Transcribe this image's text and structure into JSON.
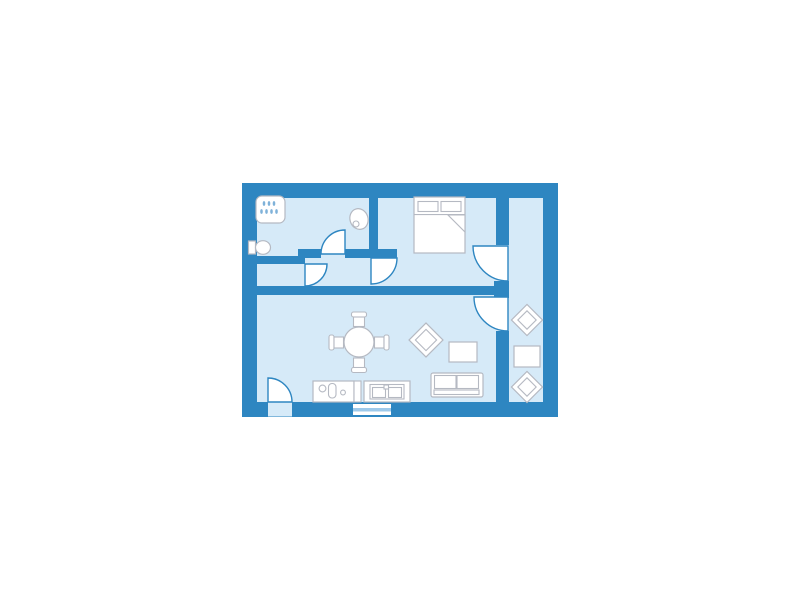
{
  "meta": {
    "canvas": {
      "width": 800,
      "height": 600,
      "background": "#ffffff"
    }
  },
  "palette": {
    "wall": "#2e86c1",
    "floor": "#d6eaf8",
    "door": "#2e86c1",
    "furn": "#b5b9c2",
    "white": "#ffffff",
    "glass": "#9ec9ea",
    "drop": "#7fb2d9"
  },
  "diagram": {
    "type": "floor-plan",
    "rooms": [
      "bathroom",
      "hall",
      "bedroom",
      "living-room-with-kitchen",
      "balcony"
    ],
    "shapes": [
      {
        "name": "apartment-floor-and-outer-wall",
        "kind": "rect",
        "x": 249.5,
        "y": 190.5,
        "w": 301,
        "h": 219,
        "fill": "floor",
        "stroke": "wall",
        "sw": 15
      },
      {
        "name": "balcony-wall-upper",
        "kind": "rect",
        "x": 496,
        "y": 198,
        "w": 13,
        "h": 47,
        "fill": "wall"
      },
      {
        "name": "balcony-wall-stub",
        "kind": "rect",
        "x": 494,
        "y": 281,
        "w": 15,
        "h": 17,
        "fill": "wall"
      },
      {
        "name": "balcony-wall-lower",
        "kind": "rect",
        "x": 496,
        "y": 331,
        "w": 13,
        "h": 71,
        "fill": "wall"
      },
      {
        "name": "living-room-north-wall",
        "kind": "rect",
        "x": 257,
        "y": 286,
        "w": 240,
        "h": 9,
        "fill": "wall"
      },
      {
        "name": "bathroom-south-wall-left",
        "kind": "rect",
        "x": 257,
        "y": 256,
        "w": 48,
        "h": 8,
        "fill": "wall"
      },
      {
        "name": "bathroom-south-wall-step",
        "kind": "rect",
        "x": 298,
        "y": 249,
        "w": 23,
        "h": 9,
        "fill": "wall"
      },
      {
        "name": "hall-north-wall-right",
        "kind": "rect",
        "x": 345,
        "y": 249,
        "w": 52,
        "h": 9,
        "fill": "wall"
      },
      {
        "name": "bedroom-west-wall",
        "kind": "rect",
        "x": 369,
        "y": 198,
        "w": 9,
        "h": 60,
        "fill": "wall"
      },
      {
        "name": "entry-doorway-gap",
        "kind": "rect",
        "x": 268,
        "y": 402.5,
        "w": 24,
        "h": 14,
        "fill": "floor"
      },
      {
        "name": "kitchen-window-frame",
        "kind": "rect",
        "x": 353,
        "y": 404,
        "w": 38,
        "h": 11,
        "fill": "white"
      },
      {
        "name": "kitchen-window-glass",
        "kind": "rect",
        "x": 353,
        "y": 408,
        "w": 38,
        "h": 3.5,
        "fill": "glass"
      },
      {
        "name": "shower-head",
        "kind": "rect",
        "x": 256,
        "y": 196,
        "w": 29,
        "h": 27,
        "rx": 6,
        "fill": "white",
        "stroke": "furn",
        "sw": 1.2
      },
      {
        "name": "shower-drop",
        "kind": "ellipse",
        "cx": 264,
        "cy": 203.5,
        "rx": 1.3,
        "ry": 2.4,
        "fill": "drop"
      },
      {
        "name": "shower-drop",
        "kind": "ellipse",
        "cx": 269,
        "cy": 203.5,
        "rx": 1.3,
        "ry": 2.4,
        "fill": "drop"
      },
      {
        "name": "shower-drop",
        "kind": "ellipse",
        "cx": 274,
        "cy": 203.5,
        "rx": 1.3,
        "ry": 2.4,
        "fill": "drop"
      },
      {
        "name": "shower-drop",
        "kind": "ellipse",
        "cx": 261.5,
        "cy": 211.5,
        "rx": 1.3,
        "ry": 2.4,
        "fill": "drop"
      },
      {
        "name": "shower-drop",
        "kind": "ellipse",
        "cx": 266.5,
        "cy": 211.5,
        "rx": 1.3,
        "ry": 2.4,
        "fill": "drop"
      },
      {
        "name": "shower-drop",
        "kind": "ellipse",
        "cx": 271.5,
        "cy": 211.5,
        "rx": 1.3,
        "ry": 2.4,
        "fill": "drop"
      },
      {
        "name": "shower-drop",
        "kind": "ellipse",
        "cx": 276.5,
        "cy": 211.5,
        "rx": 1.3,
        "ry": 2.4,
        "fill": "drop"
      },
      {
        "name": "toilet-tank",
        "kind": "rect",
        "x": 248.5,
        "y": 241,
        "w": 7,
        "h": 13,
        "fill": "white",
        "stroke": "furn",
        "sw": 1.2
      },
      {
        "name": "toilet-bowl",
        "kind": "ellipse",
        "cx": 263,
        "cy": 247.5,
        "rx": 7.5,
        "ry": 6.8,
        "fill": "white",
        "stroke": "furn",
        "sw": 1.2
      },
      {
        "name": "bathroom-sink-basin",
        "kind": "ellipse",
        "cx": 359,
        "cy": 219,
        "rx": 9,
        "ry": 10.5,
        "transform": "rotate(-18 359 219)",
        "fill": "white",
        "stroke": "furn",
        "sw": 1.2
      },
      {
        "name": "bathroom-sink-drain",
        "kind": "circle",
        "cx": 356,
        "cy": 224,
        "r": 3,
        "fill": "white",
        "stroke": "furn",
        "sw": 1.1
      },
      {
        "name": "bed",
        "kind": "rect",
        "x": 414,
        "y": 197,
        "w": 51,
        "h": 56,
        "fill": "white",
        "stroke": "furn",
        "sw": 1.2
      },
      {
        "name": "bed-pillow-left",
        "kind": "rect",
        "x": 418,
        "y": 201.5,
        "w": 20,
        "h": 10,
        "fill": "white",
        "stroke": "furn",
        "sw": 1.1
      },
      {
        "name": "bed-pillow-right",
        "kind": "rect",
        "x": 441,
        "y": 201.5,
        "w": 20,
        "h": 10,
        "fill": "white",
        "stroke": "furn",
        "sw": 1.1
      },
      {
        "name": "bed-sheet-line",
        "kind": "rect",
        "x": 414,
        "y": 214,
        "w": 51,
        "h": 1.1,
        "fill": "furn"
      },
      {
        "name": "bed-blanket-fold",
        "kind": "polygon",
        "points": "448,215 465,215 465,232",
        "fill": "white",
        "stroke": "furn",
        "sw": 1.1
      },
      {
        "name": "balcony-chair-top",
        "kind": "rect",
        "x": 516,
        "y": 309,
        "w": 22,
        "h": 22,
        "transform": "rotate(45 527 320)",
        "fill": "white",
        "stroke": "furn",
        "sw": 1.2
      },
      {
        "name": "balcony-chair-top-cushion",
        "kind": "rect",
        "x": 520.5,
        "y": 313.5,
        "w": 13,
        "h": 13,
        "transform": "rotate(45 527 320)",
        "fill": "white",
        "stroke": "furn",
        "sw": 1.1
      },
      {
        "name": "balcony-table",
        "kind": "rect",
        "x": 514,
        "y": 346,
        "w": 26,
        "h": 21,
        "fill": "white",
        "stroke": "furn",
        "sw": 1.2
      },
      {
        "name": "balcony-chair-bottom",
        "kind": "rect",
        "x": 516,
        "y": 376,
        "w": 22,
        "h": 22,
        "transform": "rotate(45 527 387)",
        "fill": "white",
        "stroke": "furn",
        "sw": 1.2
      },
      {
        "name": "balcony-chair-bottom-cushion",
        "kind": "rect",
        "x": 520.5,
        "y": 380.5,
        "w": 13,
        "h": 13,
        "transform": "rotate(45 527 387)",
        "fill": "white",
        "stroke": "furn",
        "sw": 1.1
      },
      {
        "name": "dining-chair-north-back",
        "kind": "rect",
        "x": 351.5,
        "y": 312,
        "w": 15,
        "h": 5,
        "rx": 2,
        "fill": "white",
        "stroke": "furn",
        "sw": 1.1
      },
      {
        "name": "dining-chair-north-seat",
        "kind": "rect",
        "x": 353.5,
        "y": 317,
        "w": 11,
        "h": 9.5,
        "fill": "white",
        "stroke": "furn",
        "sw": 1.1
      },
      {
        "name": "dining-chair-south-seat",
        "kind": "rect",
        "x": 353.5,
        "y": 358,
        "w": 11,
        "h": 9.5,
        "fill": "white",
        "stroke": "furn",
        "sw": 1.1
      },
      {
        "name": "dining-chair-south-back",
        "kind": "rect",
        "x": 351.5,
        "y": 367.5,
        "w": 15,
        "h": 5,
        "rx": 2,
        "fill": "white",
        "stroke": "furn",
        "sw": 1.1
      },
      {
        "name": "dining-chair-west-back",
        "kind": "rect",
        "x": 329,
        "y": 335,
        "w": 5,
        "h": 15,
        "rx": 2,
        "fill": "white",
        "stroke": "furn",
        "sw": 1.1
      },
      {
        "name": "dining-chair-west-seat",
        "kind": "rect",
        "x": 334,
        "y": 337,
        "w": 9.5,
        "h": 11,
        "fill": "white",
        "stroke": "furn",
        "sw": 1.1
      },
      {
        "name": "dining-chair-east-seat",
        "kind": "rect",
        "x": 374.5,
        "y": 337,
        "w": 9.5,
        "h": 11,
        "fill": "white",
        "stroke": "furn",
        "sw": 1.1
      },
      {
        "name": "dining-chair-east-back",
        "kind": "rect",
        "x": 384,
        "y": 335,
        "w": 5,
        "h": 15,
        "rx": 2,
        "fill": "white",
        "stroke": "furn",
        "sw": 1.1
      },
      {
        "name": "dining-table",
        "kind": "circle",
        "cx": 359,
        "cy": 342,
        "r": 15,
        "fill": "white",
        "stroke": "furn",
        "sw": 1.2
      },
      {
        "name": "armchair",
        "kind": "rect",
        "x": 414,
        "y": 328,
        "w": 24,
        "h": 24,
        "transform": "rotate(45 426 340)",
        "fill": "white",
        "stroke": "furn",
        "sw": 1.2
      },
      {
        "name": "armchair-cushion",
        "kind": "rect",
        "x": 418.5,
        "y": 332.5,
        "w": 15,
        "h": 15,
        "transform": "rotate(45 426 340)",
        "fill": "white",
        "stroke": "furn",
        "sw": 1.1
      },
      {
        "name": "coffee-table",
        "kind": "rect",
        "x": 449,
        "y": 342,
        "w": 28,
        "h": 20,
        "fill": "white",
        "stroke": "furn",
        "sw": 1.2
      },
      {
        "name": "sofa",
        "kind": "rect",
        "x": 431,
        "y": 373,
        "w": 52,
        "h": 24,
        "rx": 2,
        "fill": "white",
        "stroke": "furn",
        "sw": 1.2
      },
      {
        "name": "sofa-cushion-left",
        "kind": "rect",
        "x": 434.5,
        "y": 375.5,
        "w": 21.5,
        "h": 13,
        "fill": "white",
        "stroke": "furn",
        "sw": 1.1
      },
      {
        "name": "sofa-cushion-right",
        "kind": "rect",
        "x": 457,
        "y": 375.5,
        "w": 21.5,
        "h": 13,
        "fill": "white",
        "stroke": "furn",
        "sw": 1.1
      },
      {
        "name": "sofa-seat-front",
        "kind": "rect",
        "x": 434,
        "y": 390,
        "w": 45,
        "h": 4.5,
        "fill": "white",
        "stroke": "furn",
        "sw": 1.1
      },
      {
        "name": "kitchen-unit-left",
        "kind": "rect",
        "x": 313,
        "y": 381,
        "w": 41,
        "h": 21,
        "fill": "white",
        "stroke": "furn",
        "sw": 1.2
      },
      {
        "name": "stove-burner-large",
        "kind": "circle",
        "cx": 322.5,
        "cy": 388.5,
        "r": 3.4,
        "fill": "white",
        "stroke": "furn",
        "sw": 1.1
      },
      {
        "name": "stove-oven",
        "kind": "rect",
        "x": 328.5,
        "y": 383.5,
        "w": 7.5,
        "h": 14.5,
        "rx": 3.5,
        "fill": "white",
        "stroke": "furn",
        "sw": 1.1
      },
      {
        "name": "stove-burner-small",
        "kind": "circle",
        "cx": 343,
        "cy": 392.5,
        "r": 2.4,
        "fill": "white",
        "stroke": "furn",
        "sw": 1.1
      },
      {
        "name": "kitchen-unit-divider",
        "kind": "rect",
        "x": 354,
        "y": 381,
        "w": 7,
        "h": 21,
        "fill": "white",
        "stroke": "furn",
        "sw": 1.1
      },
      {
        "name": "kitchen-unit-right",
        "kind": "rect",
        "x": 364,
        "y": 381,
        "w": 46,
        "h": 21,
        "fill": "white",
        "stroke": "furn",
        "sw": 1.2
      },
      {
        "name": "sink-frame",
        "kind": "rect",
        "x": 370,
        "y": 384.5,
        "w": 34,
        "h": 14.5,
        "fill": "white",
        "stroke": "furn",
        "sw": 1.1
      },
      {
        "name": "sink-basin-left",
        "kind": "rect",
        "x": 372.5,
        "y": 387.5,
        "w": 13,
        "h": 10,
        "fill": "white",
        "stroke": "furn",
        "sw": 1.1
      },
      {
        "name": "sink-basin-right",
        "kind": "rect",
        "x": 388.5,
        "y": 387.5,
        "w": 13,
        "h": 10,
        "fill": "white",
        "stroke": "furn",
        "sw": 1.1
      },
      {
        "name": "sink-tap",
        "kind": "rect",
        "x": 384,
        "y": 385,
        "w": 4.5,
        "h": 4,
        "fill": "white",
        "stroke": "furn",
        "sw": 1.1
      },
      {
        "name": "entry-door-swing",
        "kind": "path",
        "d": "M268 402 L268 378 A24 24 0 0 1 292 402 Z",
        "fill": "white",
        "stroke": "door",
        "sw": 1.4
      },
      {
        "name": "bathroom-door-swing",
        "kind": "path",
        "d": "M345 254 L321 254 A24 24 0 0 1 345 230 Z",
        "fill": "white",
        "stroke": "door",
        "sw": 1.4
      },
      {
        "name": "hall-closet-door-swing",
        "kind": "path",
        "d": "M305 264 L327 264 A22 22 0 0 1 305 286 Z",
        "fill": "white",
        "stroke": "door",
        "sw": 1.4
      },
      {
        "name": "bedroom-door-swing",
        "kind": "path",
        "d": "M371 258 L397 258 A26 26 0 0 1 371 284 Z",
        "fill": "white",
        "stroke": "door",
        "sw": 1.4
      },
      {
        "name": "bedroom-balcony-door-swing",
        "kind": "path",
        "d": "M508 246 L473 246 A35 35 0 0 0 508 281 Z",
        "fill": "white",
        "stroke": "door",
        "sw": 1.4
      },
      {
        "name": "living-balcony-door-swing",
        "kind": "path",
        "d": "M508 297 L474 297 A34 34 0 0 0 508 331 Z",
        "fill": "white",
        "stroke": "door",
        "sw": 1.4
      }
    ]
  }
}
